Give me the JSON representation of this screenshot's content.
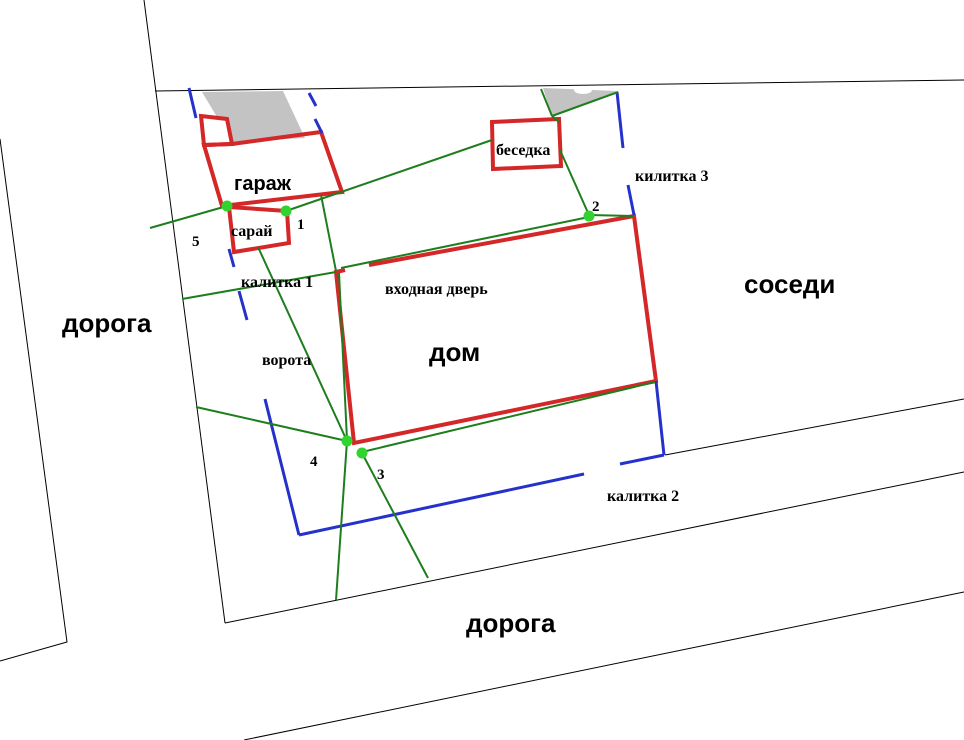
{
  "plan": {
    "width": 964,
    "height": 740,
    "background": "#ffffff",
    "colors": {
      "building": "#d42727",
      "fence": "#2531cb",
      "path": "#1e7e1e",
      "marker": "#30d330",
      "road": "#000000",
      "shade": "#c3c3c3",
      "text": "#000000"
    },
    "shade_shapes": [
      {
        "name": "garage-roof-shade",
        "pts": [
          [
            202,
            92
          ],
          [
            283,
            91
          ],
          [
            305,
            138
          ],
          [
            232,
            142
          ]
        ]
      },
      {
        "name": "corner-roof-shade-triangle",
        "pts": [
          [
            543,
            88
          ],
          [
            617,
            91
          ],
          [
            552,
            116
          ]
        ]
      }
    ],
    "road_lines": [
      {
        "name": "top-plot-boundary-line",
        "pts": [
          [
            155,
            91
          ],
          [
            964,
            80
          ]
        ]
      },
      {
        "name": "west-road-outer-edge",
        "pts": [
          [
            0,
            139
          ],
          [
            67,
            642
          ],
          [
            0,
            661
          ]
        ]
      },
      {
        "name": "west-plot-boundary-line",
        "pts": [
          [
            144,
            0
          ],
          [
            225,
            623
          ]
        ]
      },
      {
        "name": "south-plot-boundary-line",
        "pts": [
          [
            225,
            623
          ],
          [
            964,
            472
          ]
        ]
      },
      {
        "name": "south-road-outer-edge",
        "pts": [
          [
            244,
            740
          ],
          [
            964,
            592
          ]
        ]
      },
      {
        "name": "east-neighbor-road-edge",
        "pts": [
          [
            665,
            455
          ],
          [
            964,
            399
          ]
        ]
      }
    ],
    "blobs": [
      {
        "name": "boundary-whiteout-blob",
        "cx": 583,
        "cy": 90,
        "rx": 9,
        "ry": 4,
        "fill": "#ffffff"
      }
    ],
    "buildings": [
      {
        "name": "garage-annex",
        "closed": true,
        "fill": "#ffffff",
        "pts": [
          [
            201,
            116
          ],
          [
            227,
            119
          ],
          [
            232,
            144
          ],
          [
            204,
            145
          ]
        ]
      },
      {
        "name": "garage",
        "closed": true,
        "fill": "none",
        "pts": [
          [
            204,
            145
          ],
          [
            232,
            144
          ],
          [
            321,
            132
          ],
          [
            342,
            192
          ],
          [
            222,
            206
          ]
        ]
      },
      {
        "name": "shed",
        "closed": true,
        "fill": "#ffffff",
        "pts": [
          [
            229,
            207
          ],
          [
            287,
            211
          ],
          [
            289,
            243
          ],
          [
            234,
            252
          ]
        ]
      },
      {
        "name": "gazebo",
        "closed": true,
        "fill": "#ffffff",
        "pts": [
          [
            492,
            122
          ],
          [
            559,
            119
          ],
          [
            561,
            166
          ],
          [
            493,
            169
          ]
        ]
      },
      {
        "name": "house-body",
        "closed": true,
        "fill": "#ffffff",
        "stroke": "none",
        "pts": [
          [
            336,
            272
          ],
          [
            634,
            216
          ],
          [
            656,
            381
          ],
          [
            354,
            443
          ]
        ]
      },
      {
        "name": "house-walls-with-door-gap",
        "closed": false,
        "fill": "none",
        "pts": [
          [
            345,
            270
          ],
          [
            336,
            272
          ],
          [
            354,
            443
          ],
          [
            656,
            381
          ],
          [
            634,
            216
          ],
          [
            369,
            265
          ]
        ]
      }
    ],
    "fence_segments": [
      {
        "name": "fence-top-left-of-garage",
        "pts": [
          [
            189,
            88
          ],
          [
            196,
            118
          ]
        ]
      },
      {
        "name": "fence-top-right-of-garage-a",
        "pts": [
          [
            309,
            93
          ],
          [
            316,
            106
          ]
        ]
      },
      {
        "name": "fence-top-right-of-garage-b",
        "pts": [
          [
            315,
            119
          ],
          [
            322,
            133
          ]
        ]
      },
      {
        "name": "fence-east-above-gate3",
        "pts": [
          [
            617,
            92
          ],
          [
            623,
            148
          ]
        ]
      },
      {
        "name": "fence-east-below-gate3",
        "pts": [
          [
            628,
            185
          ],
          [
            634,
            215
          ]
        ]
      },
      {
        "name": "fence-west-above-gate1",
        "pts": [
          [
            229,
            249
          ],
          [
            234,
            267
          ]
        ]
      },
      {
        "name": "fence-west-below-gate1",
        "pts": [
          [
            239,
            291
          ],
          [
            247,
            320
          ]
        ]
      },
      {
        "name": "fence-west-below-vorota",
        "pts": [
          [
            265,
            399
          ],
          [
            299,
            535
          ]
        ]
      },
      {
        "name": "fence-south-west-of-gate2",
        "pts": [
          [
            299,
            535
          ],
          [
            584,
            474
          ]
        ]
      },
      {
        "name": "fence-south-east-of-gate2",
        "pts": [
          [
            620,
            464
          ],
          [
            664,
            455
          ]
        ]
      },
      {
        "name": "fence-east-below-house",
        "pts": [
          [
            664,
            455
          ],
          [
            656,
            381
          ]
        ]
      }
    ],
    "path_segments": [
      {
        "name": "path-road-to-point5",
        "pts": [
          [
            150,
            228
          ],
          [
            227,
            206
          ]
        ]
      },
      {
        "name": "path-point1-to-gazebo",
        "pts": [
          [
            286,
            211
          ],
          [
            492,
            140
          ]
        ]
      },
      {
        "name": "path-gazebo-to-point2",
        "pts": [
          [
            560,
            150
          ],
          [
            589,
            215
          ]
        ]
      },
      {
        "name": "path-shade-triangle-left-edge",
        "pts": [
          [
            541,
            89
          ],
          [
            552,
            116
          ]
        ]
      },
      {
        "name": "path-shade-triangle-right-edge",
        "pts": [
          [
            618,
            92
          ],
          [
            552,
            116
          ]
        ]
      },
      {
        "name": "path-triangle-to-gazebo",
        "pts": [
          [
            552,
            116
          ],
          [
            559,
            122
          ]
        ]
      },
      {
        "name": "path-point2-to-house-corner",
        "pts": [
          [
            589,
            215
          ],
          [
            633,
            216
          ]
        ]
      },
      {
        "name": "path-point2-to-door",
        "pts": [
          [
            589,
            217
          ],
          [
            341,
            268
          ]
        ]
      },
      {
        "name": "path-door-to-point4",
        "pts": [
          [
            339,
            273
          ],
          [
            347,
            440
          ]
        ]
      },
      {
        "name": "path-point3-to-house-se",
        "pts": [
          [
            362,
            452
          ],
          [
            655,
            382
          ]
        ]
      },
      {
        "name": "path-west-road-to-point4",
        "pts": [
          [
            196,
            407
          ],
          [
            347,
            441
          ]
        ]
      },
      {
        "name": "path-point4-to-south-road",
        "pts": [
          [
            347,
            441
          ],
          [
            336,
            600
          ]
        ]
      },
      {
        "name": "path-point3-to-south-road",
        "pts": [
          [
            362,
            453
          ],
          [
            428,
            578
          ]
        ]
      },
      {
        "name": "path-shed-to-point4-driveway",
        "pts": [
          [
            258,
            247
          ],
          [
            347,
            441
          ]
        ]
      },
      {
        "name": "path-garage-to-door",
        "pts": [
          [
            321,
            195
          ],
          [
            336,
            271
          ]
        ]
      },
      {
        "name": "path-gate1-to-door",
        "pts": [
          [
            182,
            299
          ],
          [
            336,
            272
          ]
        ]
      }
    ],
    "markers": [
      {
        "id": "1",
        "x": 286,
        "y": 211
      },
      {
        "id": "2",
        "x": 589,
        "y": 216
      },
      {
        "id": "3",
        "x": 362,
        "y": 453
      },
      {
        "id": "4",
        "x": 347,
        "y": 441
      },
      {
        "id": "5",
        "x": 227,
        "y": 206
      }
    ],
    "labels": [
      {
        "name": "road-label-west",
        "text": "дорога",
        "x": 62,
        "y": 332,
        "size": 26,
        "font": "sans"
      },
      {
        "name": "road-label-south",
        "text": "дорога",
        "x": 466,
        "y": 632,
        "size": 26,
        "font": "sans"
      },
      {
        "name": "neighbors-label",
        "text": "соседи",
        "x": 744,
        "y": 293,
        "size": 26,
        "font": "sans"
      },
      {
        "name": "house-label",
        "text": "дом",
        "x": 429,
        "y": 361,
        "size": 26,
        "font": "sans"
      },
      {
        "name": "garage-label",
        "text": "гараж",
        "x": 234,
        "y": 190,
        "size": 20,
        "font": "sans"
      },
      {
        "name": "shed-label",
        "text": "сарай",
        "x": 231,
        "y": 236,
        "size": 16,
        "font": "serif"
      },
      {
        "name": "gazebo-label",
        "text": "беседка",
        "x": 496,
        "y": 155,
        "size": 16,
        "font": "serif"
      },
      {
        "name": "entrance-door-label",
        "text": "входная дверь",
        "x": 385,
        "y": 294,
        "size": 16,
        "font": "serif"
      },
      {
        "name": "gate1-label",
        "text": "калитка 1",
        "x": 241,
        "y": 287,
        "size": 16,
        "font": "serif"
      },
      {
        "name": "gate2-label",
        "text": "калитка 2",
        "x": 607,
        "y": 501,
        "size": 16,
        "font": "serif"
      },
      {
        "name": "gate3-label",
        "text": "килитка 3",
        "x": 635,
        "y": 181,
        "size": 16,
        "font": "serif"
      },
      {
        "name": "vorota-label",
        "text": "ворота",
        "x": 262,
        "y": 365,
        "size": 16,
        "font": "serif"
      },
      {
        "name": "marker-label-1",
        "text": "1",
        "x": 297,
        "y": 229,
        "size": 15,
        "font": "serif"
      },
      {
        "name": "marker-label-2",
        "text": "2",
        "x": 592,
        "y": 211,
        "size": 15,
        "font": "serif"
      },
      {
        "name": "marker-label-3",
        "text": "3",
        "x": 377,
        "y": 479,
        "size": 15,
        "font": "serif"
      },
      {
        "name": "marker-label-4",
        "text": "4",
        "x": 310,
        "y": 466,
        "size": 15,
        "font": "serif"
      },
      {
        "name": "marker-label-5",
        "text": "5",
        "x": 192,
        "y": 246,
        "size": 15,
        "font": "serif"
      }
    ]
  }
}
